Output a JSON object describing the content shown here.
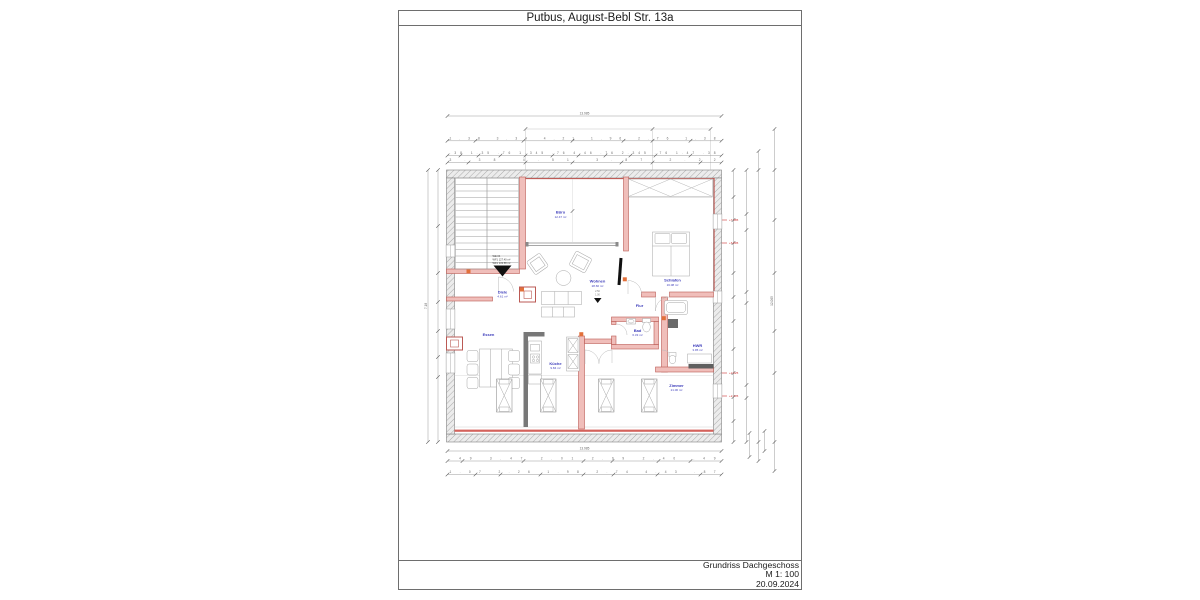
{
  "page": {
    "title": "Putbus, August-Bebl Str. 13a"
  },
  "footer": {
    "line1": "Grundriss Dachgeschoss",
    "line2": "M 1: 100",
    "line3": "20.09.2024"
  },
  "plan": {
    "unit_label": {
      "line1": "WE 04",
      "line2": "WF1 127.40 m²",
      "line3": "WF1 133.58 m²"
    },
    "rooms": {
      "buero": {
        "name": "Büro",
        "area": "12.47 m²"
      },
      "schlafen": {
        "name": "Schlafen",
        "area": "16.08 m²"
      },
      "wohnen": {
        "name": "Wohnen",
        "area": "28.66 m²"
      },
      "essen": {
        "name": "Essen",
        "area": ""
      },
      "kueche": {
        "name": "Küche",
        "area": "9.84 m²"
      },
      "bad": {
        "name": "Bad",
        "area": "6.33 m²"
      },
      "hwr": {
        "name": "HWR",
        "area": "3.95 m²"
      },
      "flur": {
        "name": "Flur",
        "area": ""
      },
      "diele": {
        "name": "Diele",
        "area": "4.61 m²"
      },
      "zimmer": {
        "name": "Zimmer",
        "area": "21.06 m²"
      }
    },
    "dimensions": {
      "overall": "13.985",
      "top1": "1.38    3.34    4.21    1.96    2.76    1.38",
      "top2": ".38 1.35 .76 1.345 .76 4.46 .76 2.345 .76 1.47 .38",
      "top3": "3.38      4.51      3.87      2.22",
      "bottom1": ".49    3.47    2.01    2.99    2.40    .49",
      "bottom2": "1.07   2.26   1.98   2.74   4.43   .87",
      "left_overall": "7.18",
      "right_overall": "12.065"
    },
    "elevations": [
      "+7.385",
      "+6.895",
      "+2.625",
      "+2.135"
    ],
    "marker": {
      "line1": "2.50",
      "line2": "1.00"
    },
    "colors": {
      "wall_red": "#bb5a54",
      "wall_fill": "#f0beba",
      "accent_orange": "#e2703a",
      "label_blue": "#3d3dbb",
      "elevation_red": "#cc3333",
      "hatch_gray": "#9a9a9a"
    }
  }
}
